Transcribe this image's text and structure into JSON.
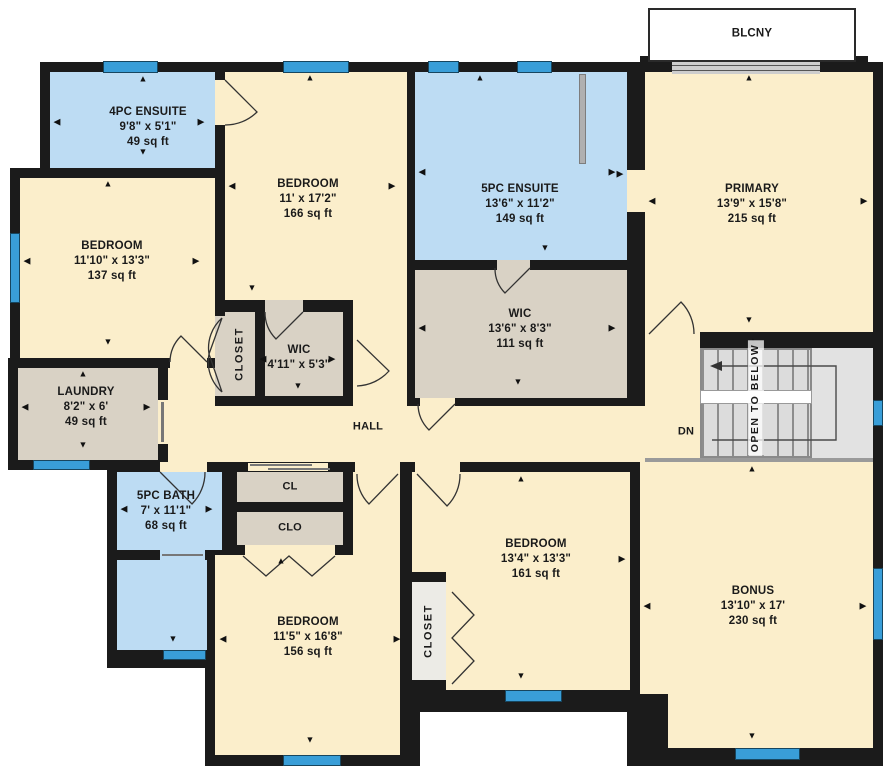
{
  "floorplan": {
    "balcony": {
      "label": "BLCNY"
    },
    "hall": {
      "label": "HALL"
    },
    "stairs": {
      "dn_label": "DN",
      "open_label": "OPEN TO BELOW"
    },
    "closets": {
      "upper_label": "CLOSET",
      "lower_label": "CLOSET",
      "cl_label": "CL",
      "clo_label": "CLO"
    },
    "rooms": {
      "ensuite_4pc": {
        "name": "4PC ENSUITE",
        "dims": "9'8\" x 5'1\"",
        "area": "49 sq ft"
      },
      "bedroom_nw": {
        "name": "BEDROOM",
        "dims": "11'10\" x 13'3\"",
        "area": "137 sq ft"
      },
      "bedroom_n": {
        "name": "BEDROOM",
        "dims": "11' x 17'2\"",
        "area": "166 sq ft"
      },
      "ensuite_5pc": {
        "name": "5PC ENSUITE",
        "dims": "13'6\" x 11'2\"",
        "area": "149 sq ft"
      },
      "primary": {
        "name": "PRIMARY",
        "dims": "13'9\" x 15'8\"",
        "area": "215 sq ft"
      },
      "wic_primary": {
        "name": "WIC",
        "dims": "13'6\" x 8'3\"",
        "area": "111 sq ft"
      },
      "wic_small": {
        "name": "WIC",
        "dims": "4'11\" x 5'3\""
      },
      "laundry": {
        "name": "LAUNDRY",
        "dims": "8'2\" x 6'",
        "area": "49 sq ft"
      },
      "bath_5pc": {
        "name": "5PC BATH",
        "dims": "7' x 11'1\"",
        "area": "68 sq ft"
      },
      "bedroom_s": {
        "name": "BEDROOM",
        "dims": "13'4\" x 13'3\"",
        "area": "161 sq ft"
      },
      "bedroom_sw": {
        "name": "BEDROOM",
        "dims": "11'5\" x 16'8\"",
        "area": "156 sq ft"
      },
      "bonus": {
        "name": "BONUS",
        "dims": "13'10\" x 17'",
        "area": "230 sq ft"
      }
    },
    "colors": {
      "wall": "#1b1b1b",
      "room_cream": "#fbeecb",
      "room_blue": "#bddcf3",
      "room_tan": "#d9d2c5",
      "room_closet": "#ecebe6",
      "window_blue": "#399ed8",
      "stairs_gray": "#dcdcdc"
    }
  }
}
